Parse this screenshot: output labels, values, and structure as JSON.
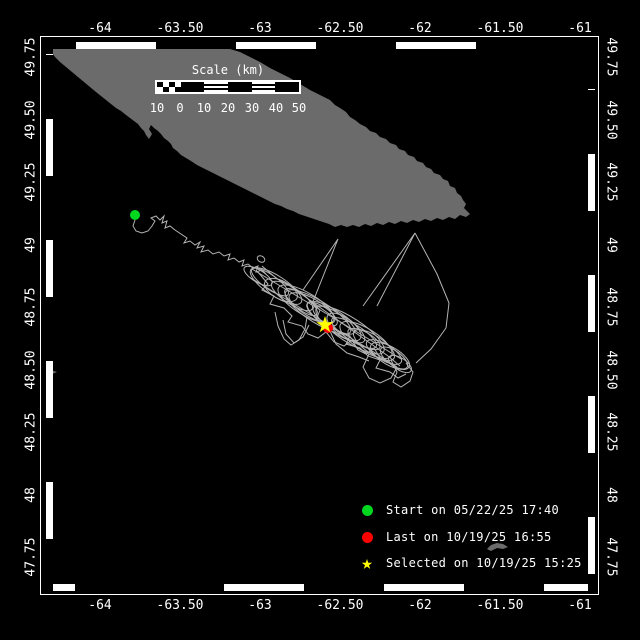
{
  "colors": {
    "background": "#000000",
    "land": "#6b6b6b",
    "track": "#b4b4b4",
    "start": "#00d820",
    "last": "#ff0000",
    "selected": "#ffff00",
    "frame": "#ffffff",
    "text": "#ffffff"
  },
  "axes": {
    "top": [
      "-64",
      "-63.50",
      "-63",
      "-62.50",
      "-62",
      "-61.50",
      "-61"
    ],
    "bottom": [
      "-64",
      "-63.50",
      "-63",
      "-62.50",
      "-62",
      "-61.50",
      "-61"
    ],
    "left": [
      "49.75",
      "49.50",
      "49.25",
      "49",
      "48.75",
      "48.50",
      "48.25",
      "48",
      "47.75"
    ],
    "right": [
      "49.75",
      "49.50",
      "49.25",
      "49",
      "48.75",
      "48.50",
      "48.25",
      "48",
      "47.75"
    ]
  },
  "scalebar": {
    "title": "Scale (km)",
    "labels": [
      "10",
      "0",
      "10",
      "20",
      "30",
      "40",
      "50"
    ]
  },
  "legend": [
    {
      "marker": "start-dot",
      "label": "Start on 05/22/25 17:40"
    },
    {
      "marker": "last-dot",
      "label": "Last on 10/19/25 16:55"
    },
    {
      "marker": "selected-star",
      "label": "Selected on 10/19/25 15:25"
    }
  ],
  "map": {
    "island": "52,49 230,49 240,52 250,57 260,62 270,68 280,73 290,78 300,84 310,90 320,95 330,100 335,105 340,108 346,112 350,117 355,120 360,124 366,127 370,131 376,133 380,137 386,139 390,143 396,145 399,149 405,151 408,155 414,157 417,161 423,163 426,167 431,169 434,173 440,175 443,179 448,181 450,186 455,188 457,193 461,196 463,200 466,204 464,208 467,211 470,214 466,217 460,215 455,219 449,217 443,220 437,218 431,221 425,219 419,222 413,220 407,223 401,221 395,224 389,222 383,225 377,223 371,226 365,224 359,227 353,225 347,227 341,225 335,227 329,224 323,222 317,220 311,218 305,216 299,214 293,211 287,209 281,206 275,204 269,201 263,198 257,195 251,192 245,189 239,186 233,183 227,180 221,177 215,174 209,171 203,168 197,165 191,161 186,158 181,155 177,151 173,148 171,144 168,141 164,138 161,134 158,131 154,128 151,125 149,129 152,134 149,139 146,135 144,131 141,128 138,124 134,121 130,118 126,115 121,111 116,108 111,104 106,100 101,96 96,92 90,87 84,82 78,77 72,72 66,67 60,62 55,57 52,53",
    "islet": "487,549 491,545 497,543 503,544 508,547 503,549 497,548 491,551",
    "west_tip": "47,369 57,372 47,376",
    "track": {
      "wander": "135,220 133,226 136,231 142,233 148,231 152,226 155,221 151,218 156,216 160,220 164,216 162,223 167,221 165,228 170,226 175,230 181,234 187,238 184,243 190,241 195,245 200,242 197,248 204,246 201,252 208,250 213,254 219,252 224,256 230,254 228,260 234,258 239,262 244,260 242,266 248,264 253,268 258,266 256,272 262,270 266,274",
      "extras": [
        "275,312 278,326 284,339 291,345 299,340 305,329 307,317",
        "283,320 286,334 294,343 303,337 309,325",
        "391,360 397,372 393,382 401,387 410,381 413,372 406,363",
        "369,354 363,367 369,378 380,383 391,378 396,369",
        "329,329 336,344 347,353 359,357 369,361",
        "252,269 282,287 312,305 342,323 372,341 401,359",
        "249,277 279,295 309,313 339,331 369,349 397,367",
        "258,272 268,284 262,290 274,296 270,304 284,308 292,316 288,322 302,326 308,334 318,338 326,332 334,342 344,346 352,340 358,350 366,354 374,348 380,358 388,362",
        "262,266 276,278 290,286 304,296 318,306 332,316 346,326 360,336 374,346 388,356 400,366",
        "310,300 320,310 316,320 330,324 338,332 350,336 346,344 360,348 368,356 380,360 376,368 390,372 398,378 406,374"
      ],
      "loops": [
        [
          258,
          276,
          16,
          6,
          31
        ],
        [
          270,
          282,
          22,
          7,
          35
        ],
        [
          281,
          290,
          18,
          9,
          28
        ],
        [
          292,
          296,
          24,
          8,
          33
        ],
        [
          301,
          302,
          20,
          7,
          38
        ],
        [
          312,
          308,
          26,
          9,
          30
        ],
        [
          322,
          314,
          18,
          7,
          35
        ],
        [
          334,
          320,
          24,
          8,
          31
        ],
        [
          344,
          327,
          20,
          9,
          36
        ],
        [
          354,
          333,
          26,
          8,
          32
        ],
        [
          364,
          339,
          18,
          7,
          29
        ],
        [
          374,
          345,
          24,
          9,
          34
        ],
        [
          384,
          352,
          20,
          8,
          31
        ],
        [
          394,
          358,
          16,
          7,
          36
        ],
        [
          400,
          364,
          13,
          6,
          32
        ],
        [
          276,
          286,
          30,
          10,
          33
        ],
        [
          306,
          304,
          32,
          11,
          31
        ],
        [
          336,
          322,
          34,
          10,
          34
        ],
        [
          366,
          340,
          30,
          11,
          32
        ],
        [
          390,
          356,
          22,
          9,
          30
        ],
        [
          350,
          330,
          40,
          12,
          33
        ],
        [
          318,
          312,
          38,
          11,
          32
        ],
        [
          261,
          259,
          4,
          3,
          30
        ]
      ],
      "spikes": [
        "303,290 338,239 312,304",
        "363,306 415,233 377,306",
        "415,233 437,274 449,303 446,328 431,349 416,363"
      ]
    },
    "markers": {
      "start": {
        "x": 135,
        "y": 215
      },
      "last": {
        "x": 328,
        "y": 328
      },
      "selected": {
        "x": 325,
        "y": 325
      }
    }
  }
}
